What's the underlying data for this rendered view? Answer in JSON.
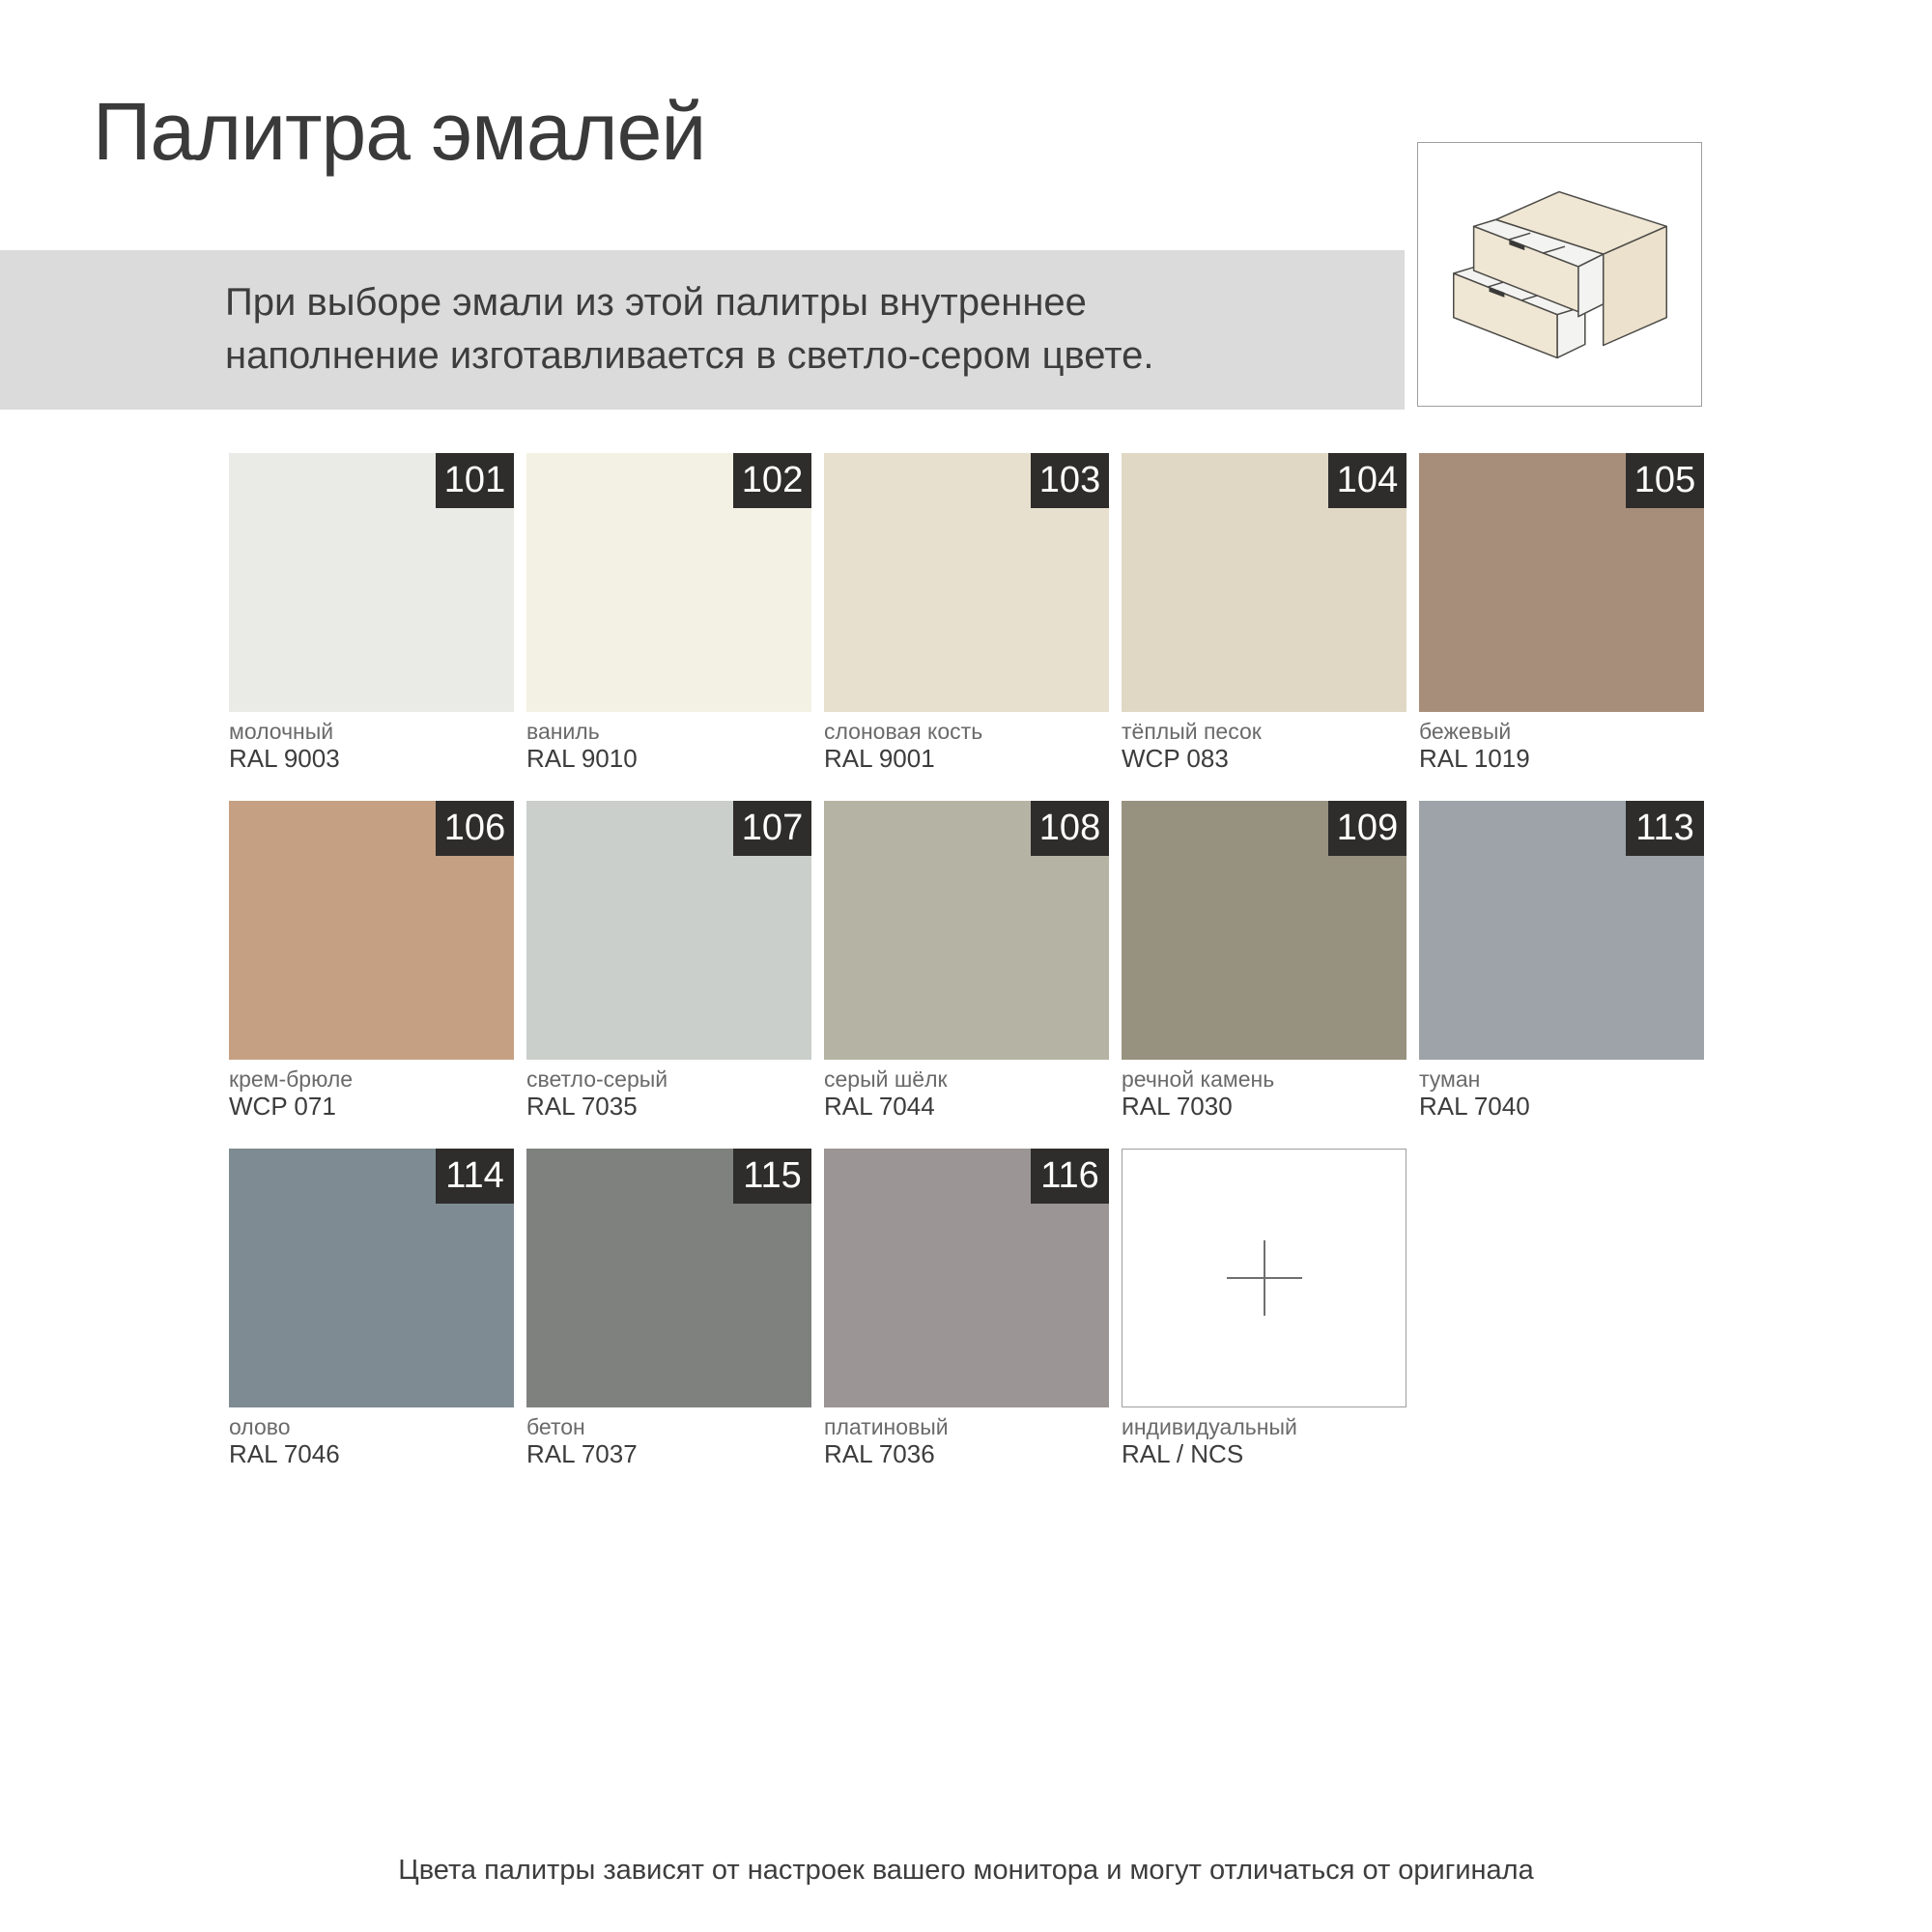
{
  "page": {
    "title": "Палитра эмалей",
    "banner_text": "При выборе эмали из этой палитры внутреннее наполнение изготавливается в светло-сером цвете.",
    "footnote": "Цвета палитры зависят от настроек вашего монитора и могут отличаться от оригинала"
  },
  "icons": {
    "illustration": "cabinet-two-open-drawers-illustration",
    "custom_swatch_icon": "plus-icon"
  },
  "colors": {
    "banner_bg": "#DBDBDB",
    "badge_bg": "#2E2D2B",
    "badge_text": "#FFFFFF",
    "text_primary": "#3A3A3A",
    "text_secondary": "#6A6A6A",
    "swatch_border": "#9E9E9E",
    "illustration_beige": "#EFE6D3",
    "illustration_outline": "#4B4A47"
  },
  "swatches": [
    {
      "number": "101",
      "name": "молочный",
      "code": "RAL 9003",
      "color": "#EAEBE6",
      "custom": false
    },
    {
      "number": "102",
      "name": "ваниль",
      "code": "RAL 9010",
      "color": "#F2F1E3",
      "custom": false
    },
    {
      "number": "103",
      "name": "слоновая кость",
      "code": "RAL 9001",
      "color": "#E7E0CE",
      "custom": false
    },
    {
      "number": "104",
      "name": "тёплый песок",
      "code": "WCP 083",
      "color": "#E0D8C5",
      "custom": false
    },
    {
      "number": "105",
      "name": "бежевый",
      "code": "RAL 1019",
      "color": "#A78E7A",
      "custom": false
    },
    {
      "number": "106",
      "name": "крем-брюле",
      "code": "WCP 071",
      "color": "#C5A082",
      "custom": false
    },
    {
      "number": "107",
      "name": "светло-серый",
      "code": "RAL 7035",
      "color": "#CACFCB",
      "custom": false
    },
    {
      "number": "108",
      "name": "серый шёлк",
      "code": "RAL 7044",
      "color": "#B5B4A4",
      "custom": false
    },
    {
      "number": "109",
      "name": "речной камень",
      "code": "RAL 7030",
      "color": "#97917F",
      "custom": false
    },
    {
      "number": "113",
      "name": "туман",
      "code": "RAL 7040",
      "color": "#9DA3A8",
      "custom": false
    },
    {
      "number": "114",
      "name": "олово",
      "code": "RAL 7046",
      "color": "#7E8B92",
      "custom": false
    },
    {
      "number": "115",
      "name": "бетон",
      "code": "RAL 7037",
      "color": "#7F817F",
      "custom": false
    },
    {
      "number": "116",
      "name": "платиновый",
      "code": "RAL 7036",
      "color": "#9B9596",
      "custom": false
    },
    {
      "number": "",
      "name": "индивидуальный",
      "code": "RAL / NCS",
      "color": "#FFFFFF",
      "custom": true
    }
  ]
}
